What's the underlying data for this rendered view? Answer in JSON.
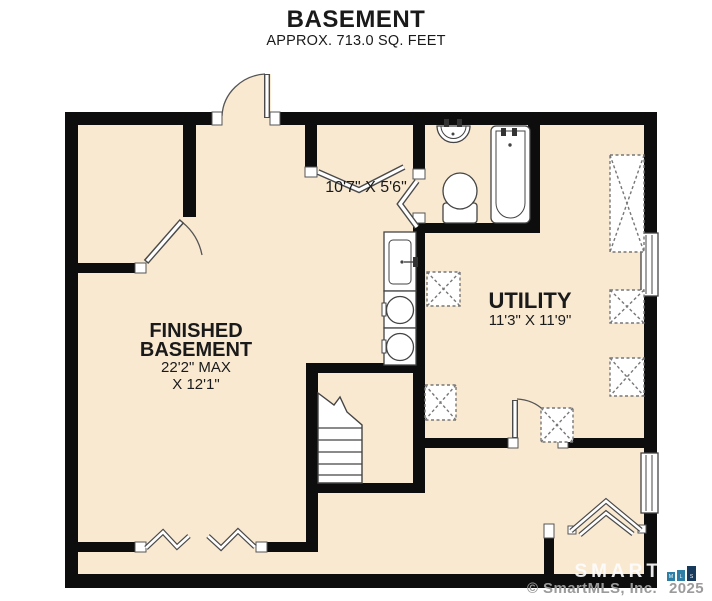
{
  "page": {
    "title": "BASEMENT",
    "subtitle": "APPROX. 713.0 SQ. FEET"
  },
  "rooms": {
    "finished_basement": {
      "name_line1": "FINISHED",
      "name_line2": "BASEMENT",
      "dim_line1": "22'2\" MAX",
      "dim_line2": "X 12'1\""
    },
    "utility": {
      "name": "UTILITY",
      "dims": "11'3\" X 11'9\""
    },
    "hall": {
      "dims": "10'7\" X 5'6\""
    }
  },
  "fixtures": [
    "bathroom-sink",
    "toilet",
    "bathtub",
    "laundry-sink",
    "washer",
    "dryer",
    "stairs",
    "equipment-boxes",
    "windows",
    "door-swings"
  ],
  "watermark": {
    "brand": "SMART",
    "logo_blocks": [
      "M",
      "L",
      "S"
    ],
    "copyright": "© SmartMLS, Inc.",
    "year": "2025"
  },
  "colors": {
    "floor": "#f9e9d1",
    "wall": "#0d0d0d",
    "line": "#4a4a4a",
    "logo_blue": "#2e7ea6",
    "logo_navy": "#17395c",
    "copyright_gray": "#9b9b9b"
  }
}
